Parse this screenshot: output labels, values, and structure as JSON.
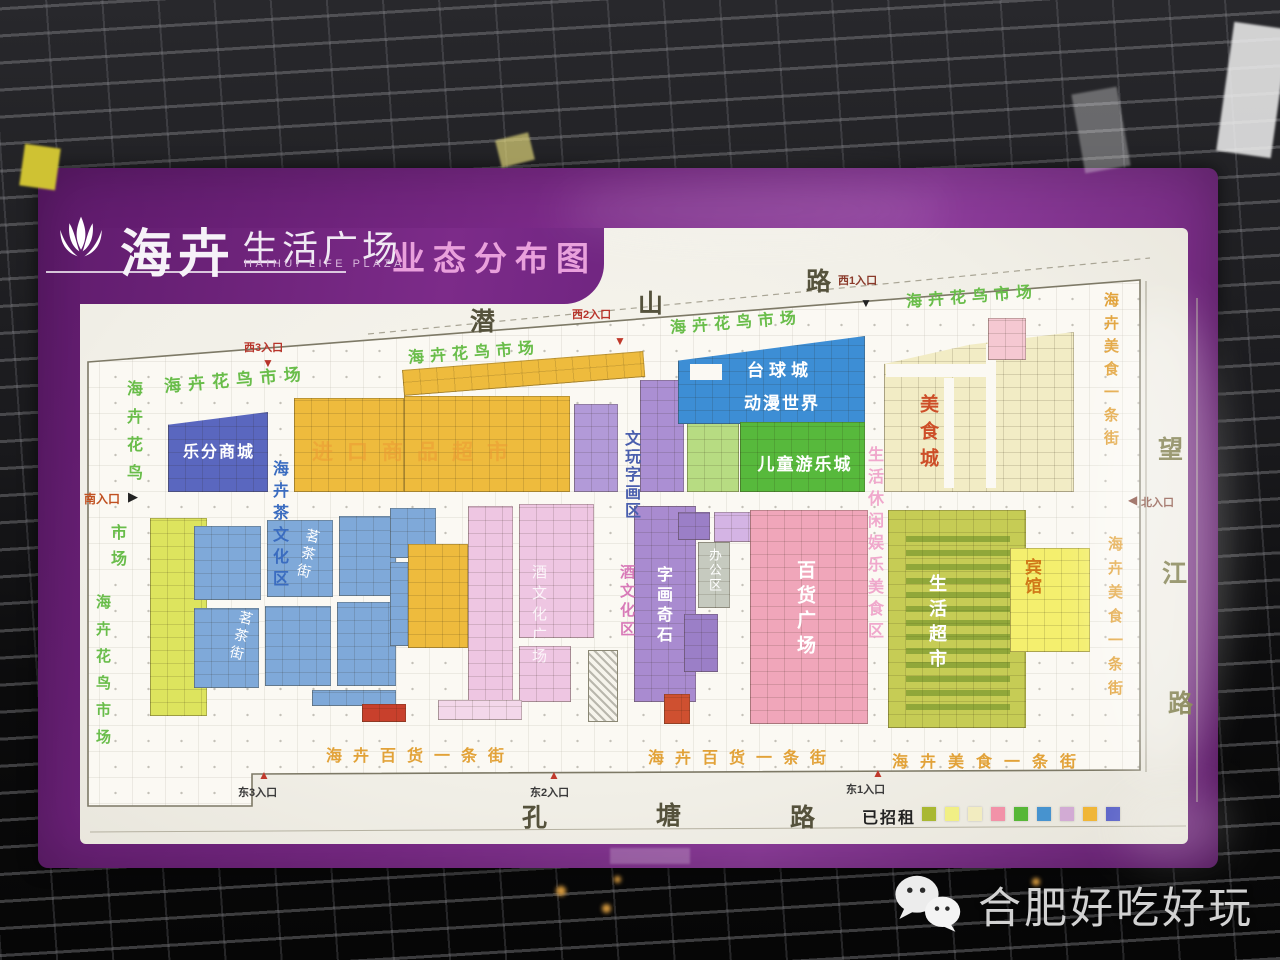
{
  "poster": {
    "logo": {
      "brand": "海卉",
      "suffix": "生活广场",
      "latin": "HAIHUI LIFE PLAZA",
      "title": "业态分布图"
    },
    "colors": {
      "frame_purple": "#7b2a88",
      "title_pink": "#e9a0dc"
    }
  },
  "roads": {
    "qianshan": [
      "潜",
      "山",
      "路"
    ],
    "wangjiang": [
      "望",
      "江",
      "路"
    ],
    "kongtang": [
      "孔",
      "塘",
      "路"
    ]
  },
  "entrances": {
    "west3": "西3入口",
    "west2": "西2入口",
    "west1": "西1入口",
    "north": "北入口",
    "south": "南入口",
    "east3": "东3入口",
    "east2": "东2入口",
    "east1": "东1入口"
  },
  "glyphs": {
    "up": "▲",
    "down": "▼",
    "left": "◀",
    "right": "▶"
  },
  "labels": {
    "fb_market": "海卉花鸟市场",
    "fb": "海卉花鸟",
    "market": "市场",
    "lefen": "乐分商城",
    "import_sm": "进口商品超市",
    "wenwan": "文玩字画区",
    "billiards": "台球城",
    "anime": "动漫世界",
    "kids": "儿童游乐城",
    "food_city": "美食城",
    "food_street": "海卉美食一条街",
    "tea_zone": "海卉茶文化区",
    "tea_street": "茗茶街",
    "wine_zone": "酒文化区",
    "wine_plaza": "酒文化广场",
    "callig_stone": "字画奇石",
    "office": "办公区",
    "dept_plaza": "百货广场",
    "leisure": "生活休闲娱乐美食区",
    "supermarket": "生活超市",
    "hotel": "宾馆",
    "dept_street": "海卉百货一条街"
  },
  "legend": {
    "label": "已招租",
    "colors": [
      "#a9b832",
      "#f1ef85",
      "#f2ecc0",
      "#f292a8",
      "#57b737",
      "#4793cf",
      "#d2abd4",
      "#f0b637",
      "#5c64c8"
    ]
  },
  "palette": {
    "billiards_blue": "#3d8ed5",
    "lefen_blue": "#5a67bf",
    "tea_blue": "#7fa9d9",
    "zone_yellow": "#eebb3d",
    "zone_purple": "#a98bd0",
    "dept_pink": "#f0a6ba",
    "soft_pink": "#eec6e2",
    "kids_green": "#57b93c",
    "chartreuse": "#dde45e",
    "olive": "#c6cc55",
    "cream": "#f2ecc5",
    "hotel_yellow": "#f4ef6e",
    "office_gray": "#c6cabf",
    "red_unit": "#c8402c",
    "green_text": "#69bd4a",
    "orange_text": "#e2a238"
  },
  "watermark": {
    "text": "合肥好吃好玩"
  }
}
